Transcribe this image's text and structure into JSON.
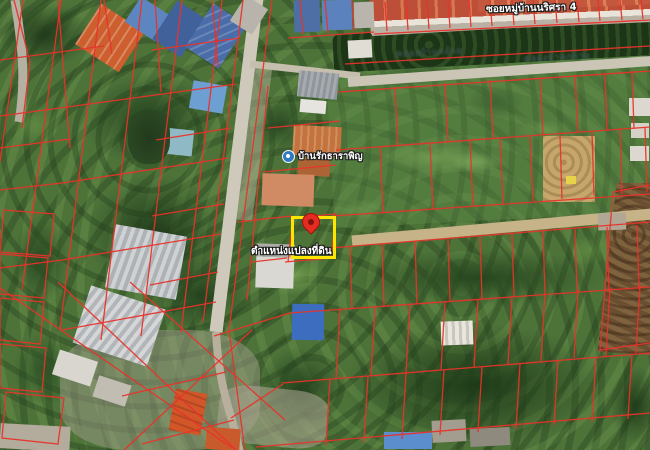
{
  "labels": {
    "street": "ซอยหมู่บ้านนริศรา 4",
    "canal_west": "คลองบ้านกล้วย",
    "canal_east": "คลองบ้านกล้วย",
    "poi": "บ้านรักธาราพิญ",
    "target": "ตำแหน่งแปลงที่ดิน"
  },
  "colors": {
    "parcel_line": "#e8332a",
    "highlight_box": "#ffe600",
    "pin": "#e62c22",
    "pin_inner": "#7e120c",
    "poi_icon": "#2f7ac2",
    "label_text": "#ffffff",
    "canal_text": "#24404d"
  },
  "icons": {
    "location_pin": "red-map-pin",
    "poi_marker": "blue-circle-dot"
  }
}
